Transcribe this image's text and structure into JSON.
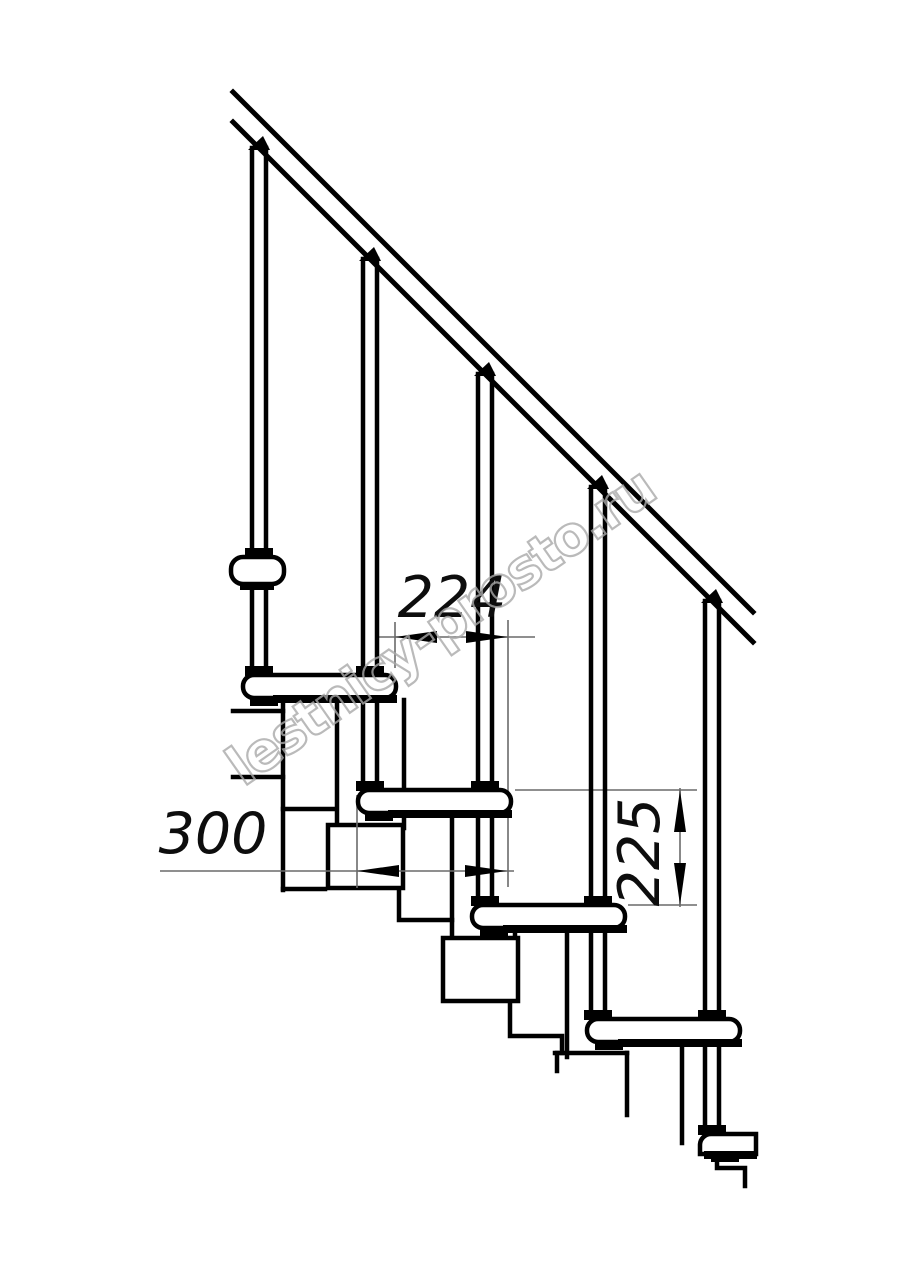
{
  "page": {
    "background": "#ffffff",
    "kind": "technical drawing"
  },
  "drawing": {
    "subject": "modular-staircase-side-elevation",
    "ink_color": "#000000",
    "thin_line_color": "#6a6a6a",
    "dimensions": {
      "step_run": "224",
      "tread_depth": "300",
      "riser_height": "225"
    }
  },
  "watermark": {
    "text": "lestnicy-prosto.ru",
    "stroke_color": "#a9a9a9"
  }
}
